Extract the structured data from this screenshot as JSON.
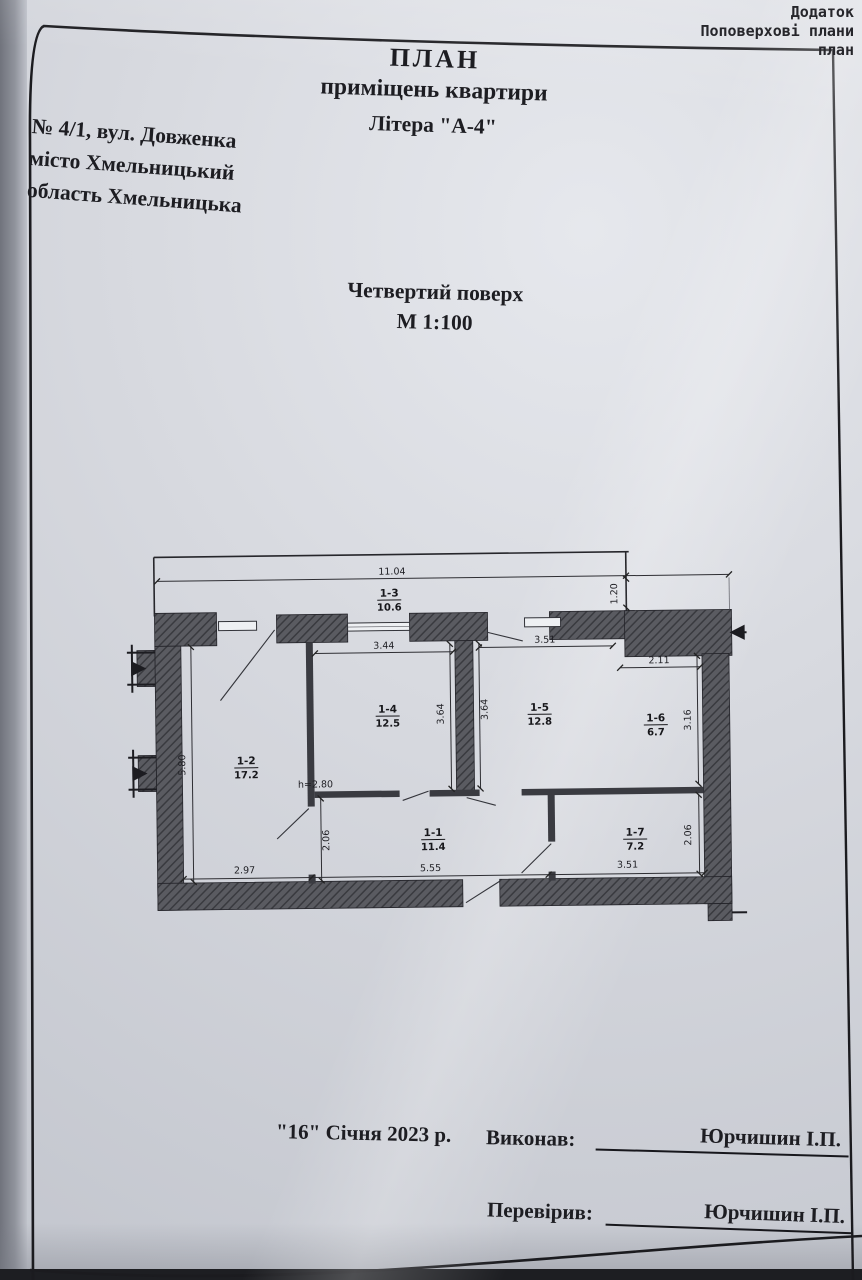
{
  "corner_note": {
    "line1": "Додаток",
    "line2": "Поповерхові плани",
    "line3": "план"
  },
  "header": {
    "title": "ПЛАН",
    "subtitle1": "приміщень квартири",
    "subtitle2": "Літера \"А-4\""
  },
  "address": {
    "line1": "№ 4/1, вул. Довженка",
    "line2": "місто Хмельницький",
    "line3": "область Хмельницька"
  },
  "floor_info": {
    "floor": "Четвертий поверх",
    "scale": "М 1:100"
  },
  "plan": {
    "rooms": [
      {
        "number": "1-1",
        "area": "11.4"
      },
      {
        "number": "1-2",
        "area": "17.2"
      },
      {
        "number": "1-3",
        "area": "10.6"
      },
      {
        "number": "1-4",
        "area": "12.5"
      },
      {
        "number": "1-5",
        "area": "12.8"
      },
      {
        "number": "1-6",
        "area": "6.7"
      },
      {
        "number": "1-7",
        "area": "7.2"
      }
    ],
    "dims": {
      "overall_width": "11.04",
      "balcony_depth": "1.20",
      "top_left_width": "3.44",
      "top_right_width": "3.51",
      "room6_width": "2.11",
      "room4_height": "3.64",
      "room5_height": "3.64",
      "room6_height": "3.16",
      "left_height": "5.80",
      "ceiling_height": "h=2.80",
      "hall_left_height": "2.06",
      "bottom_left_width": "2.97",
      "bottom_middle_width": "5.55",
      "bottom_right_width": "3.51",
      "room7_height": "2.06"
    }
  },
  "footer": {
    "date": "\"16\" Січня 2023 р.",
    "executor_label": "Виконав:",
    "executor_name": "Юрчишин І.П.",
    "checker_label": "Перевірив:",
    "checker_name": "Юрчишин І.П."
  }
}
